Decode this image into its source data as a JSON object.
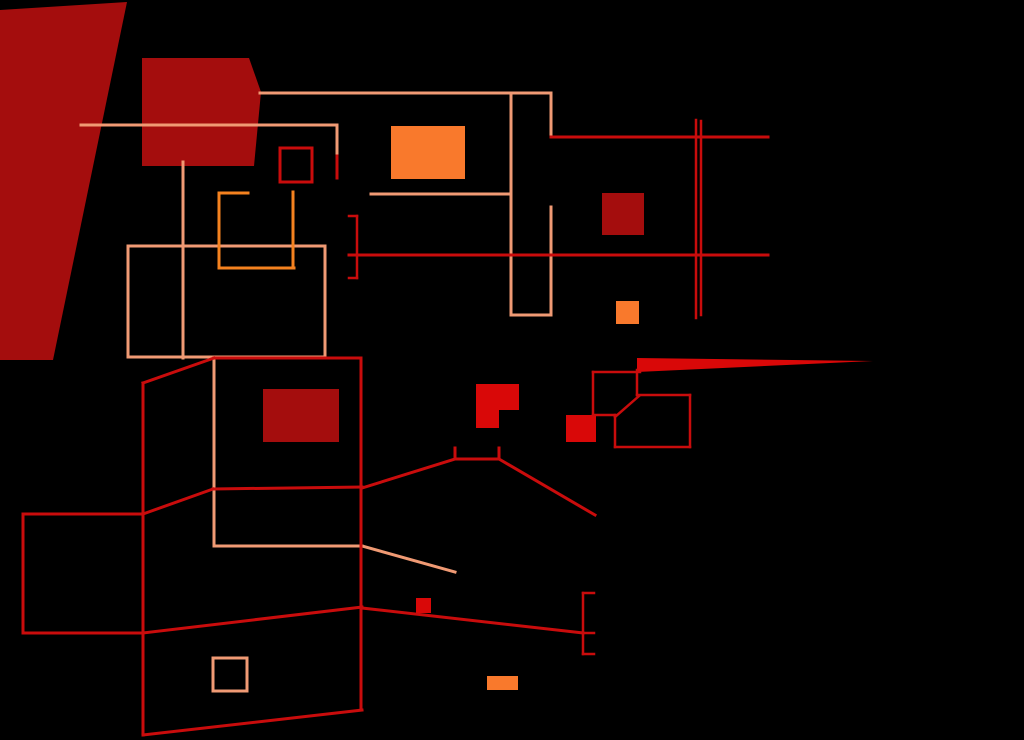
{
  "view": {
    "title": "automap",
    "width": 1024,
    "height": 740,
    "background": "#000000"
  },
  "palette": {
    "dark_red": "#A40D0D",
    "bright_red": "#D90808",
    "red_line": "#C90C0C",
    "salmon": "#F09A74",
    "orange_line": "#F5821F",
    "orange_fill": "#F9792C"
  },
  "map": {
    "filled_polygons": [
      {
        "name": "sector-large-left-trapezoid",
        "color": "dark_red",
        "points": "0,10 127,2 53,360 0,360"
      },
      {
        "name": "sector-upper-hexagon",
        "color": "dark_red",
        "points": "142,58 249,58 261,92 254,166 142,166"
      },
      {
        "name": "marker-long-spike",
        "color": "bright_red",
        "points": "637,358 873,361 637,372"
      },
      {
        "name": "marker-l-shape",
        "color": "bright_red",
        "points": "476,384 519,384 519,410 499,410 499,428 476,428"
      }
    ],
    "filled_rects": [
      {
        "name": "sector-dark-square-right",
        "color": "dark_red",
        "x": 602,
        "y": 193,
        "w": 42,
        "h": 42
      },
      {
        "name": "sector-dark-rect-mid-left",
        "color": "dark_red",
        "x": 263,
        "y": 389,
        "w": 76,
        "h": 53
      },
      {
        "name": "marker-red-square-mid",
        "color": "bright_red",
        "x": 566,
        "y": 415,
        "w": 30,
        "h": 27
      },
      {
        "name": "marker-red-square-small",
        "color": "bright_red",
        "x": 416,
        "y": 598,
        "w": 15,
        "h": 15
      },
      {
        "name": "item-orange-rect-top",
        "color": "orange_fill",
        "x": 391,
        "y": 126,
        "w": 74,
        "h": 53
      },
      {
        "name": "item-orange-square-mid",
        "color": "orange_fill",
        "x": 616,
        "y": 301,
        "w": 23,
        "h": 23
      },
      {
        "name": "item-orange-rect-bottom",
        "color": "orange_fill",
        "x": 487,
        "y": 676,
        "w": 31,
        "h": 14
      }
    ],
    "outline_rects": [
      {
        "name": "room-red-small-square",
        "color": "red_line",
        "stroke": 3,
        "x": 280,
        "y": 148,
        "w": 32,
        "h": 34
      },
      {
        "name": "room-salmon-large",
        "color": "salmon",
        "stroke": 3,
        "x": 128,
        "y": 246,
        "w": 197,
        "h": 111
      },
      {
        "name": "room-salmon-small-square",
        "color": "salmon",
        "stroke": 3,
        "x": 213,
        "y": 658,
        "w": 34,
        "h": 33
      }
    ],
    "wall_lines": [
      {
        "color": "salmon",
        "w": 3,
        "pts": [
          260,
          93,
          551,
          93
        ]
      },
      {
        "color": "salmon",
        "w": 3,
        "pts": [
          511,
          93,
          511,
          315
        ]
      },
      {
        "color": "salmon",
        "w": 3,
        "pts": [
          551,
          93,
          551,
          136
        ]
      },
      {
        "color": "salmon",
        "w": 3,
        "pts": [
          551,
          207,
          551,
          315
        ]
      },
      {
        "color": "salmon",
        "w": 3,
        "pts": [
          511,
          315,
          551,
          315
        ]
      },
      {
        "color": "salmon",
        "w": 3,
        "pts": [
          371,
          194,
          511,
          194
        ]
      },
      {
        "color": "salmon",
        "w": 3,
        "pts": [
          81,
          125,
          337,
          125
        ]
      },
      {
        "color": "salmon",
        "w": 3,
        "pts": [
          337,
          125,
          337,
          156
        ]
      },
      {
        "color": "salmon",
        "w": 3,
        "pts": [
          183,
          162,
          183,
          358
        ]
      },
      {
        "color": "salmon",
        "w": 3,
        "pts": [
          214,
          358,
          214,
          546
        ]
      },
      {
        "color": "salmon",
        "w": 3,
        "pts": [
          214,
          546,
          362,
          546
        ]
      },
      {
        "color": "salmon",
        "w": 3,
        "pts": [
          362,
          546,
          455,
          572
        ]
      },
      {
        "color": "orange_line",
        "w": 3,
        "pts": [
          219,
          193,
          248,
          193
        ]
      },
      {
        "color": "orange_line",
        "w": 3,
        "pts": [
          219,
          193,
          219,
          268
        ]
      },
      {
        "color": "orange_line",
        "w": 3,
        "pts": [
          219,
          268,
          294,
          268
        ]
      },
      {
        "color": "orange_line",
        "w": 3,
        "pts": [
          293,
          192,
          293,
          268
        ]
      },
      {
        "color": "red_line",
        "w": 3,
        "pts": [
          551,
          137,
          768,
          137
        ]
      },
      {
        "color": "red_line",
        "w": 3,
        "pts": [
          349,
          255,
          768,
          255
        ]
      },
      {
        "color": "red_line",
        "w": 2.5,
        "pts": [
          696,
          120,
          696,
          318
        ]
      },
      {
        "color": "red_line",
        "w": 2.5,
        "pts": [
          701,
          121,
          701,
          315
        ]
      },
      {
        "color": "red_line",
        "w": 2.5,
        "pts": [
          349,
          216,
          357,
          216
        ]
      },
      {
        "color": "red_line",
        "w": 2.5,
        "pts": [
          357,
          216,
          357,
          278
        ]
      },
      {
        "color": "red_line",
        "w": 2.5,
        "pts": [
          349,
          278,
          357,
          278
        ]
      },
      {
        "color": "red_line",
        "w": 3,
        "pts": [
          337,
          156,
          337,
          178
        ]
      },
      {
        "color": "red_line",
        "w": 3,
        "pts": [
          214,
          358,
          361,
          358
        ]
      },
      {
        "color": "red_line",
        "w": 3,
        "pts": [
          361,
          358,
          361,
          710
        ]
      },
      {
        "color": "red_line",
        "w": 3,
        "pts": [
          214,
          358,
          143,
          383
        ]
      },
      {
        "color": "red_line",
        "w": 3,
        "pts": [
          143,
          383,
          143,
          735
        ]
      },
      {
        "color": "red_line",
        "w": 3,
        "pts": [
          213,
          489,
          362,
          487
        ]
      },
      {
        "color": "red_line",
        "w": 3,
        "pts": [
          143,
          514,
          213,
          489
        ]
      },
      {
        "color": "red_line",
        "w": 3,
        "pts": [
          23,
          514,
          143,
          514
        ]
      },
      {
        "color": "red_line",
        "w": 3,
        "pts": [
          23,
          514,
          23,
          633
        ]
      },
      {
        "color": "red_line",
        "w": 3,
        "pts": [
          23,
          633,
          143,
          633
        ]
      },
      {
        "color": "red_line",
        "w": 3,
        "pts": [
          143,
          633,
          362,
          607
        ]
      },
      {
        "color": "red_line",
        "w": 3,
        "pts": [
          143,
          735,
          362,
          710
        ]
      },
      {
        "color": "red_line",
        "w": 3,
        "pts": [
          362,
          488,
          455,
          459
        ]
      },
      {
        "color": "red_line",
        "w": 3,
        "pts": [
          455,
          459,
          499,
          459
        ]
      },
      {
        "color": "red_line",
        "w": 3,
        "pts": [
          455,
          448,
          455,
          459
        ]
      },
      {
        "color": "red_line",
        "w": 3,
        "pts": [
          499,
          448,
          499,
          459
        ]
      },
      {
        "color": "red_line",
        "w": 3,
        "pts": [
          499,
          459,
          595,
          515
        ]
      },
      {
        "color": "red_line",
        "w": 3,
        "pts": [
          362,
          608,
          583,
          633
        ]
      },
      {
        "color": "red_line",
        "w": 2.5,
        "pts": [
          583,
          593,
          583,
          654
        ]
      },
      {
        "color": "red_line",
        "w": 2.5,
        "pts": [
          583,
          593,
          594,
          593
        ]
      },
      {
        "color": "red_line",
        "w": 2.5,
        "pts": [
          583,
          633,
          594,
          633
        ]
      },
      {
        "color": "red_line",
        "w": 2.5,
        "pts": [
          583,
          654,
          594,
          654
        ]
      },
      {
        "color": "red_line",
        "w": 2.5,
        "pts": [
          593,
          372,
          640,
          372
        ]
      },
      {
        "color": "red_line",
        "w": 2.5,
        "pts": [
          593,
          372,
          593,
          415
        ]
      },
      {
        "color": "red_line",
        "w": 2.5,
        "pts": [
          593,
          415,
          615,
          415
        ]
      },
      {
        "color": "red_line",
        "w": 2.5,
        "pts": [
          637,
          370,
          637,
          395
        ]
      },
      {
        "color": "red_line",
        "w": 2.5,
        "pts": [
          637,
          395,
          690,
          395
        ]
      },
      {
        "color": "red_line",
        "w": 2.5,
        "pts": [
          690,
          395,
          690,
          447
        ]
      },
      {
        "color": "red_line",
        "w": 2.5,
        "pts": [
          615,
          447,
          690,
          447
        ]
      },
      {
        "color": "red_line",
        "w": 2.5,
        "pts": [
          615,
          415,
          615,
          447
        ]
      },
      {
        "color": "red_line",
        "w": 2.5,
        "pts": [
          615,
          417,
          639,
          396
        ]
      }
    ]
  }
}
